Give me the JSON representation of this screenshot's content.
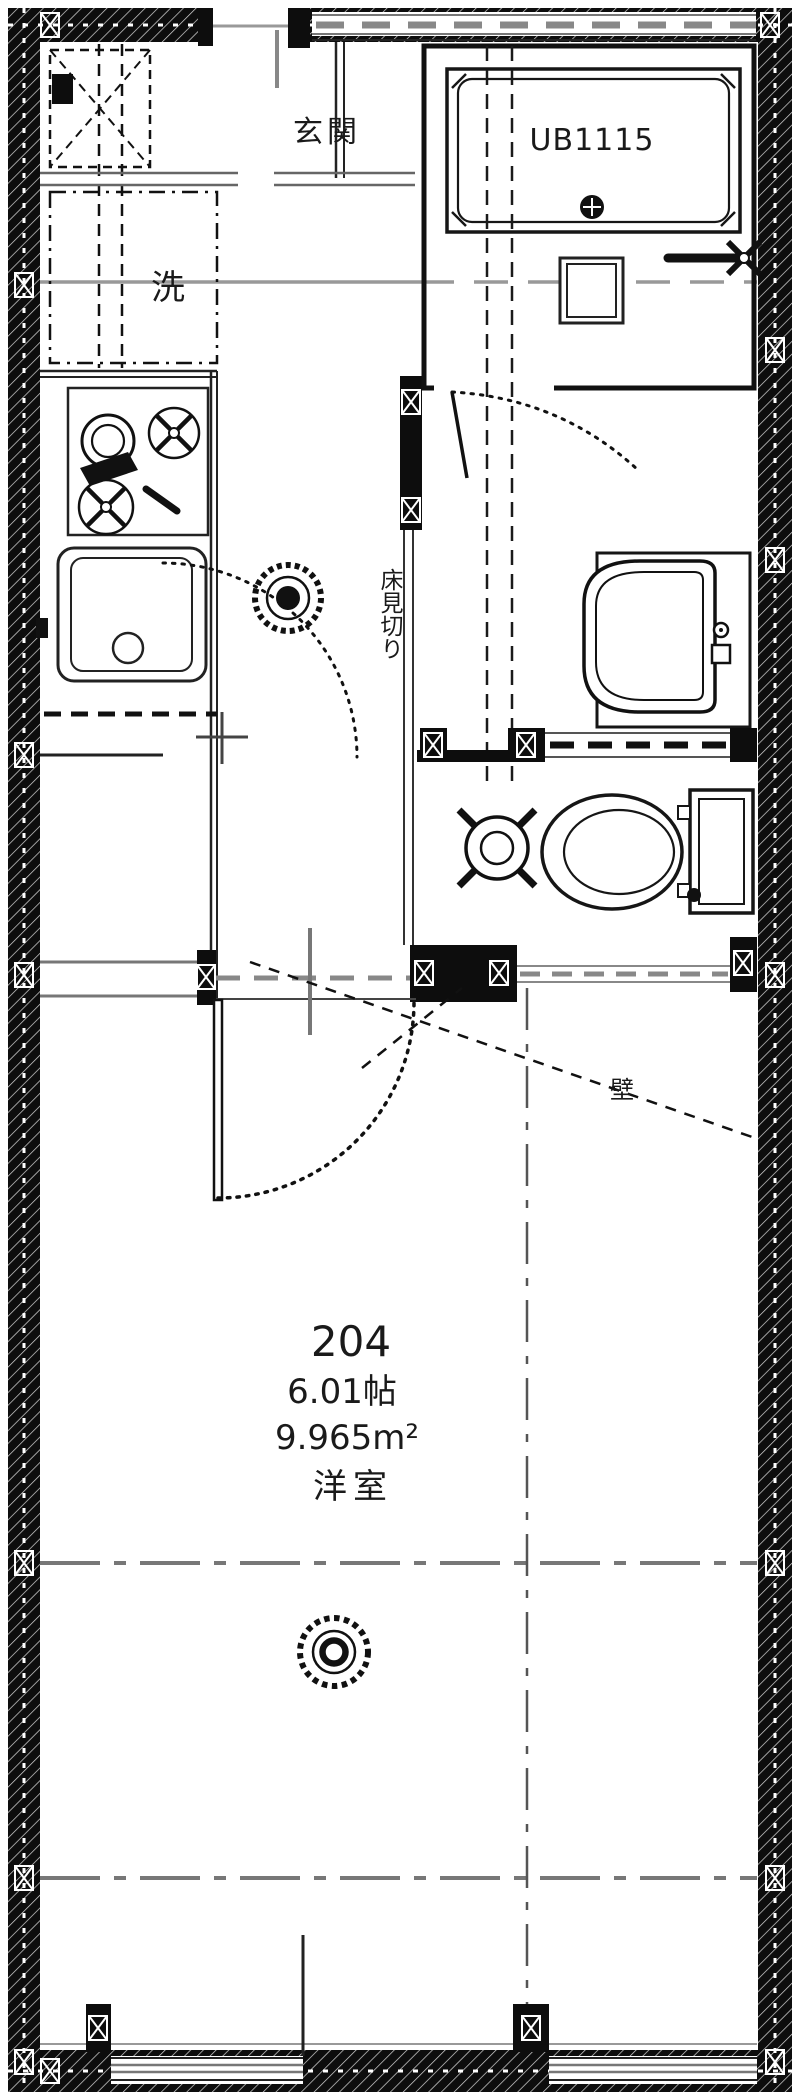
{
  "plan": {
    "labels": {
      "entrance": "玄関",
      "laundry": "洗",
      "unit_bath": "UB1115",
      "floor_divider": "床見切り",
      "wall_note": "壁"
    },
    "room": {
      "number": "204",
      "area_jo": "6.01帖",
      "area_m2": "9.965m²",
      "type": "洋室"
    },
    "symbols": [
      "smoke-detector-icon",
      "ceiling-light-icon",
      "bathtub",
      "bath-drain-icon",
      "bath-faucet-icon",
      "toilet",
      "drain-pipe-icon",
      "washbasin",
      "kitchen-sink",
      "gas-stove",
      "door-swing-arc",
      "washing-machine-space",
      "wall-junction-x-mark"
    ],
    "colors": {
      "wall_fill": "#0d0d0d",
      "line": "#1a1a1a",
      "gray_line": "#777777",
      "light_gray": "#999999",
      "background": "#ffffff"
    }
  }
}
